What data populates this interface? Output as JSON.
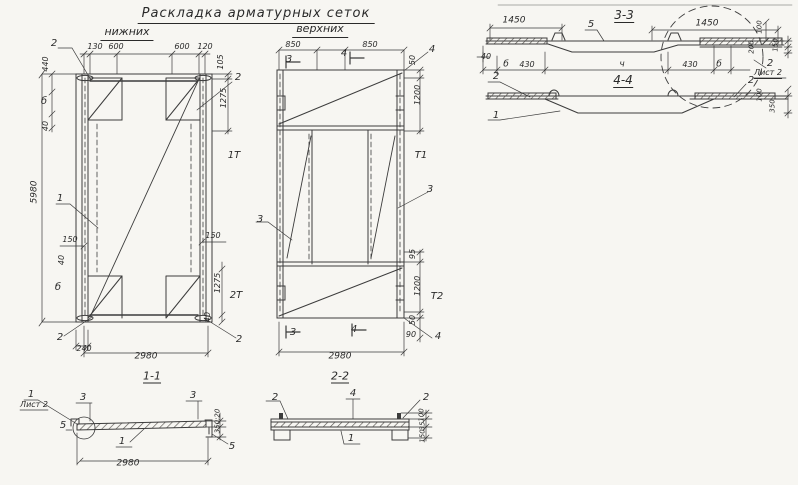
{
  "header": {
    "title": "Раскладка арматурных сеток",
    "subtitle_left": "нижних",
    "subtitle_right": "верхних"
  },
  "colors": {
    "ink": "#3c3c3c",
    "paper": "#f7f6f2"
  },
  "labels": {
    "plan_lower": [
      {
        "t": "2",
        "x": 54,
        "y": 44,
        "n": "callout-mesh-2"
      },
      {
        "t": "130",
        "x": 95,
        "y": 47,
        "s": 8
      },
      {
        "t": "600",
        "x": 116,
        "y": 47,
        "s": 8
      },
      {
        "t": "600",
        "x": 182,
        "y": 47,
        "s": 8
      },
      {
        "t": "120",
        "x": 205,
        "y": 47,
        "s": 8
      },
      {
        "t": "440",
        "x": 46,
        "y": 64,
        "r": -90,
        "s": 8
      },
      {
        "t": "б",
        "x": 44,
        "y": 102,
        "s": 10
      },
      {
        "t": "40",
        "x": 46,
        "y": 126,
        "r": -90,
        "s": 8
      },
      {
        "t": "105",
        "x": 221,
        "y": 62,
        "r": -90,
        "s": 8
      },
      {
        "t": "2",
        "x": 238,
        "y": 78,
        "n": "callout-mesh-2"
      },
      {
        "t": "1275",
        "x": 224,
        "y": 98,
        "r": -90,
        "s": 8
      },
      {
        "t": "1Т",
        "x": 234,
        "y": 156,
        "n": "section-mark-1"
      },
      {
        "t": "1",
        "x": 60,
        "y": 199,
        "n": "callout-mesh-1"
      },
      {
        "t": "5980",
        "x": 35,
        "y": 192,
        "r": -90,
        "s": 9
      },
      {
        "t": "150",
        "x": 70,
        "y": 240,
        "s": 8
      },
      {
        "t": "150",
        "x": 213,
        "y": 236,
        "s": 8
      },
      {
        "t": "40",
        "x": 62,
        "y": 260,
        "r": -90,
        "s": 8
      },
      {
        "t": "б",
        "x": 58,
        "y": 288,
        "s": 10
      },
      {
        "t": "1275",
        "x": 218,
        "y": 283,
        "r": -90,
        "s": 8
      },
      {
        "t": "2Т",
        "x": 236,
        "y": 296,
        "n": "section-mark-2"
      },
      {
        "t": "40",
        "x": 208,
        "y": 317,
        "r": -90,
        "s": 8
      },
      {
        "t": "2",
        "x": 60,
        "y": 338,
        "n": "callout-mesh-2"
      },
      {
        "t": "2",
        "x": 239,
        "y": 340,
        "n": "callout-mesh-2"
      },
      {
        "t": "240",
        "x": 84,
        "y": 349,
        "s": 8
      },
      {
        "t": "2980",
        "x": 146,
        "y": 357,
        "s": 9
      }
    ],
    "plan_upper": [
      {
        "t": "850",
        "x": 293,
        "y": 45,
        "s": 8
      },
      {
        "t": "850",
        "x": 370,
        "y": 45,
        "s": 8
      },
      {
        "t": "3",
        "x": 289,
        "y": 60,
        "n": "section-mark-3"
      },
      {
        "t": "4",
        "x": 344,
        "y": 54,
        "n": "section-mark-4"
      },
      {
        "t": "4",
        "x": 432,
        "y": 50,
        "n": "callout-mesh-4"
      },
      {
        "t": "50",
        "x": 413,
        "y": 60,
        "r": -90,
        "s": 8
      },
      {
        "t": "1200",
        "x": 418,
        "y": 95,
        "r": -90,
        "s": 8
      },
      {
        "t": "Т1",
        "x": 421,
        "y": 156,
        "n": "section-mark-1"
      },
      {
        "t": "3",
        "x": 430,
        "y": 190,
        "n": "callout-mesh-3"
      },
      {
        "t": "3",
        "x": 260,
        "y": 220,
        "n": "callout-mesh-3"
      },
      {
        "t": "95",
        "x": 413,
        "y": 254,
        "r": -90,
        "s": 8
      },
      {
        "t": "1200",
        "x": 418,
        "y": 286,
        "r": -90,
        "s": 8
      },
      {
        "t": "Т2",
        "x": 437,
        "y": 297,
        "n": "section-mark-2"
      },
      {
        "t": "50",
        "x": 413,
        "y": 320,
        "r": -90,
        "s": 8
      },
      {
        "t": "90",
        "x": 411,
        "y": 335,
        "s": 8
      },
      {
        "t": "4",
        "x": 438,
        "y": 337,
        "n": "callout-mesh-4"
      },
      {
        "t": "3",
        "x": 293,
        "y": 333,
        "n": "section-mark-3"
      },
      {
        "t": "4",
        "x": 354,
        "y": 330,
        "n": "section-mark-4"
      },
      {
        "t": "2980",
        "x": 340,
        "y": 357,
        "s": 9
      }
    ],
    "section_33": [
      {
        "t": "3-3",
        "x": 624,
        "y": 16,
        "s": 12,
        "u": 1,
        "n": "section-title"
      },
      {
        "t": "1450",
        "x": 514,
        "y": 21,
        "s": 9
      },
      {
        "t": "1450",
        "x": 707,
        "y": 24,
        "s": 9
      },
      {
        "t": "5",
        "x": 591,
        "y": 25,
        "n": "callout-mesh-5"
      },
      {
        "t": "100",
        "x": 760,
        "y": 27,
        "r": -90,
        "s": 7
      },
      {
        "t": "200",
        "x": 752,
        "y": 47,
        "r": -90,
        "s": 7
      },
      {
        "t": "150",
        "x": 776,
        "y": 45,
        "r": -90,
        "s": 7
      },
      {
        "t": "40",
        "x": 486,
        "y": 57,
        "s": 8
      },
      {
        "t": "б",
        "x": 506,
        "y": 65,
        "s": 9
      },
      {
        "t": "430",
        "x": 527,
        "y": 65,
        "s": 8
      },
      {
        "t": "ч",
        "x": 622,
        "y": 65,
        "s": 9
      },
      {
        "t": "430",
        "x": 690,
        "y": 65,
        "s": 8
      },
      {
        "t": "б",
        "x": 719,
        "y": 65,
        "s": 9
      },
      {
        "t": "2",
        "x": 770,
        "y": 64,
        "n": "callout-mesh-2"
      },
      {
        "t": "Лист 2",
        "x": 768,
        "y": 74,
        "s": 8,
        "u": 1,
        "n": "sheet-ref"
      }
    ],
    "section_44": [
      {
        "t": "4-4",
        "x": 623,
        "y": 81,
        "s": 12,
        "u": 1,
        "n": "section-title"
      },
      {
        "t": "2",
        "x": 496,
        "y": 77,
        "n": "callout-mesh-2"
      },
      {
        "t": "1",
        "x": 496,
        "y": 116,
        "n": "callout-mesh-1"
      },
      {
        "t": "2",
        "x": 751,
        "y": 81,
        "n": "callout-mesh-2"
      },
      {
        "t": "100",
        "x": 760,
        "y": 95,
        "r": -90,
        "s": 7
      },
      {
        "t": "350",
        "x": 773,
        "y": 106,
        "r": -90,
        "s": 7
      }
    ],
    "section_11": [
      {
        "t": "1-1",
        "x": 152,
        "y": 377,
        "s": 11,
        "u": 1,
        "n": "section-title"
      },
      {
        "t": "1",
        "x": 31,
        "y": 395,
        "n": "callout-mesh-1"
      },
      {
        "t": "Лист 2",
        "x": 34,
        "y": 405,
        "s": 8,
        "n": "sheet-ref"
      },
      {
        "t": "3",
        "x": 83,
        "y": 398,
        "n": "callout-mesh-3"
      },
      {
        "t": "3",
        "x": 193,
        "y": 396,
        "n": "callout-mesh-3"
      },
      {
        "t": "5",
        "x": 63,
        "y": 426,
        "n": "callout-mesh-5"
      },
      {
        "t": "5",
        "x": 232,
        "y": 447,
        "n": "callout-mesh-5"
      },
      {
        "t": "1",
        "x": 122,
        "y": 442,
        "n": "callout-mesh-1"
      },
      {
        "t": "350;20",
        "x": 218,
        "y": 421,
        "r": -90,
        "s": 7
      },
      {
        "t": "2980",
        "x": 128,
        "y": 464,
        "s": 9
      }
    ],
    "section_22": [
      {
        "t": "2-2",
        "x": 340,
        "y": 377,
        "s": 11,
        "u": 1,
        "n": "section-title"
      },
      {
        "t": "2",
        "x": 275,
        "y": 398,
        "n": "callout-mesh-2"
      },
      {
        "t": "4",
        "x": 353,
        "y": 394,
        "n": "callout-mesh-4"
      },
      {
        "t": "2",
        "x": 426,
        "y": 398,
        "n": "callout-mesh-2"
      },
      {
        "t": "1",
        "x": 351,
        "y": 439,
        "n": "callout-mesh-1"
      },
      {
        "t": "100",
        "x": 422,
        "y": 415,
        "r": -90,
        "s": 7
      },
      {
        "t": "35",
        "x": 423,
        "y": 426,
        "r": -90,
        "s": 7
      },
      {
        "t": "150",
        "x": 423,
        "y": 436,
        "r": -90,
        "s": 7
      }
    ]
  }
}
